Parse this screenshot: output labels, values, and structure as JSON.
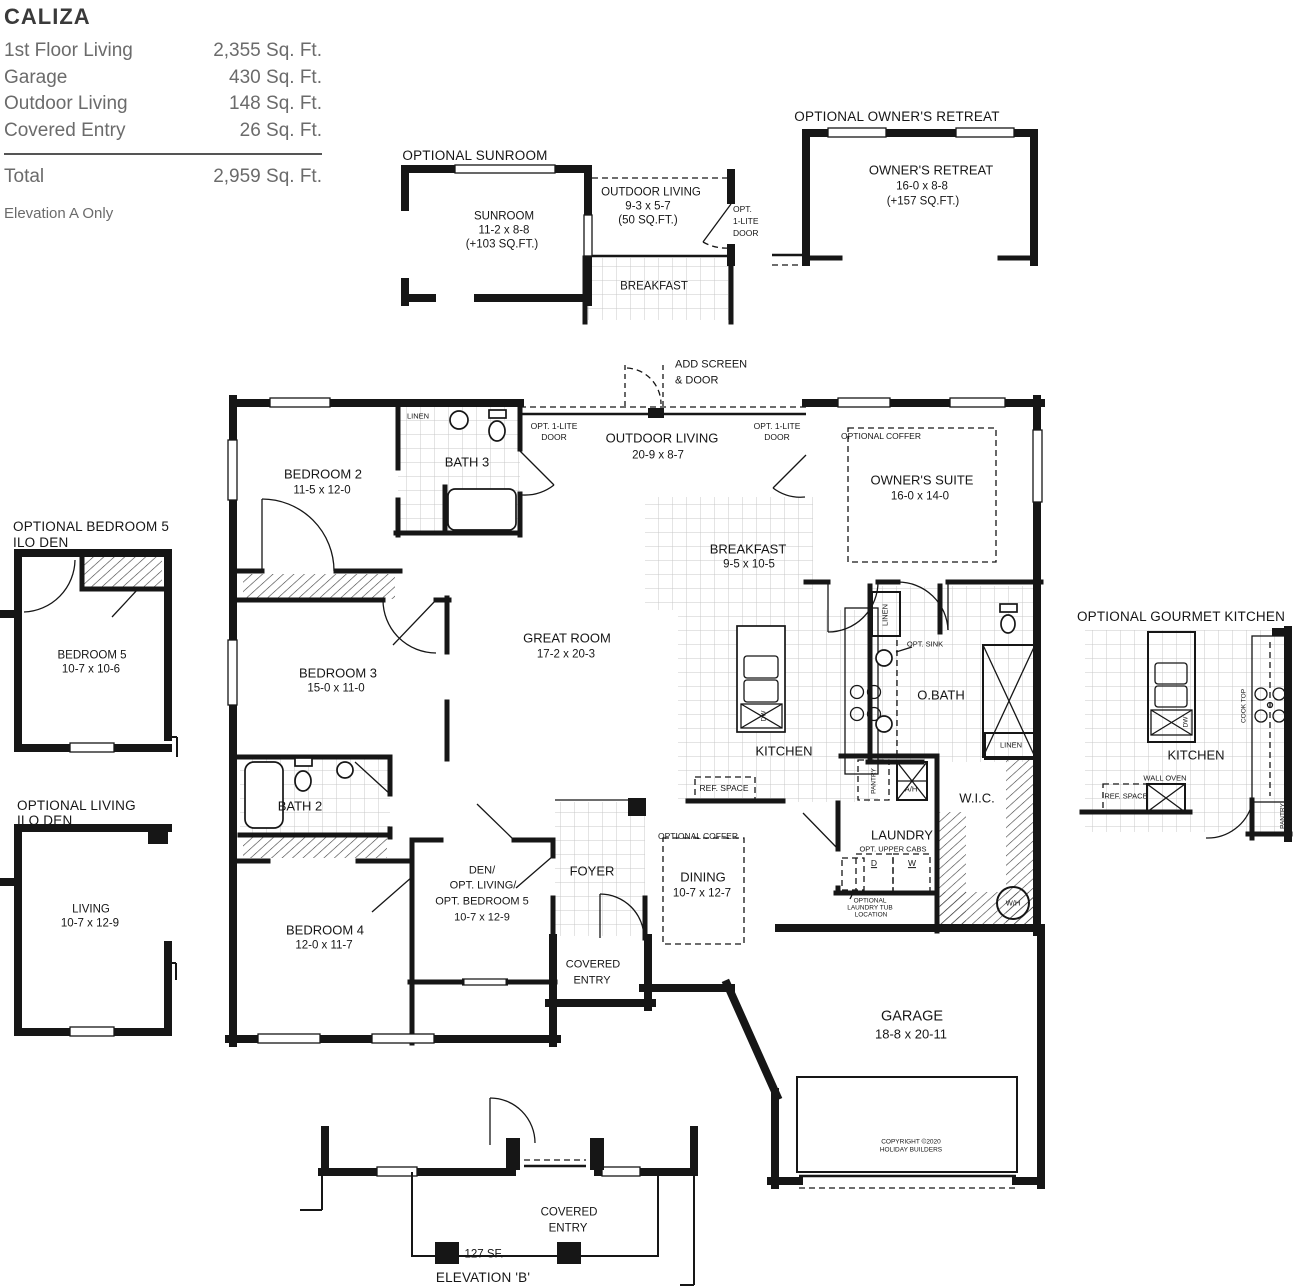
{
  "spec": {
    "title": "CALIZA",
    "rows": [
      {
        "label": "1st Floor Living",
        "value": "2,355 Sq. Ft."
      },
      {
        "label": "Garage",
        "value": "430 Sq. Ft."
      },
      {
        "label": "Outdoor Living",
        "value": "148 Sq. Ft."
      },
      {
        "label": "Covered Entry",
        "value": "26 Sq. Ft."
      }
    ],
    "total": {
      "label": "Total",
      "value": "2,959 Sq. Ft."
    },
    "note": "Elevation A Only"
  },
  "main": {
    "add_screen": [
      "ADD SCREEN",
      "& DOOR"
    ],
    "opt_door": [
      "OPT. 1-LITE",
      "DOOR"
    ],
    "outdoor_living": {
      "name": "OUTDOOR LIVING",
      "dims": "20-9 x 8-7"
    },
    "bedroom2": {
      "name": "BEDROOM 2",
      "dims": "11-5 x 12-0"
    },
    "bath3": {
      "name": "BATH 3",
      "linen": "LINEN"
    },
    "owners_suite": {
      "coffer": "OPTIONAL COFFER",
      "name": "OWNER'S SUITE",
      "dims": "16-0 x 14-0"
    },
    "breakfast": {
      "name": "BREAKFAST",
      "dims": "9-5 x 10-5"
    },
    "great_room": {
      "name": "GREAT ROOM",
      "dims": "17-2 x 20-3"
    },
    "bedroom3": {
      "name": "BEDROOM 3",
      "dims": "15-0 x 11-0"
    },
    "bath2": {
      "name": "BATH 2"
    },
    "obath": {
      "name": "O.BATH",
      "opt_sink": "OPT. SINK",
      "linen_v": "LINEN",
      "linen_h": "LINEN"
    },
    "kitchen": {
      "name": "KITCHEN",
      "ref_space": "REF. SPACE",
      "pantry": "PANTRY",
      "dw": "DW"
    },
    "laundry": {
      "name": "LAUNDRY",
      "upper_cabs": "OPT. UPPER CABS",
      "d": "D",
      "w": "W",
      "ah": "A/H",
      "tub": [
        "OPTIONAL",
        "LAUNDRY TUB",
        "LOCATION"
      ]
    },
    "wic": {
      "name": "W.I.C.",
      "wh": "W/H"
    },
    "dining": {
      "coffer": "OPTIONAL COFFER",
      "name": "DINING",
      "dims": "10-7 x 12-7"
    },
    "den": [
      "DEN/",
      "OPT. LIVING/",
      "OPT. BEDROOM 5",
      "10-7 x 12-9"
    ],
    "foyer": {
      "name": "FOYER"
    },
    "covered_entry": [
      "COVERED",
      "ENTRY"
    ],
    "bedroom4": {
      "name": "BEDROOM 4",
      "dims": "12-0 x 11-7"
    },
    "garage": {
      "name": "GARAGE",
      "dims": "18-8 x 20-11",
      "copyright": [
        "COPYRIGHT ©2020",
        "HOLIDAY BUILDERS"
      ]
    }
  },
  "sunroom_inset": {
    "title": "OPTIONAL SUNROOM",
    "name": "SUNROOM",
    "dims": "11-2 x 8-8",
    "area": "(+103 SQ.FT.)",
    "outdoor_living": {
      "name": "OUTDOOR LIVING",
      "dims": "9-3 x 5-7",
      "area": "(50 SQ.FT.)"
    },
    "door": [
      "OPT.",
      "1-LITE",
      "DOOR"
    ],
    "breakfast": "BREAKFAST"
  },
  "retreat_inset": {
    "title": "OPTIONAL OWNER'S RETREAT",
    "name": "OWNER'S RETREAT",
    "dims": "16-0 x 8-8",
    "area": "(+157 SQ.FT.)"
  },
  "bedroom5_inset": {
    "title": [
      "OPTIONAL BEDROOM 5",
      "ILO DEN"
    ],
    "name": "BEDROOM 5",
    "dims": "10-7 x 10-6"
  },
  "living_inset": {
    "title": [
      "OPTIONAL LIVING",
      "ILO DEN"
    ],
    "name": "LIVING",
    "dims": "10-7 x 12-9"
  },
  "gourmet_inset": {
    "title": "OPTIONAL GOURMET KITCHEN",
    "kitchen": "KITCHEN",
    "cook_top": "COOK TOP",
    "wall_oven": "WALL OVEN",
    "ref_space": "REF. SPACE",
    "pantry": "PANTRY",
    "dw": "DW"
  },
  "elevation_inset": {
    "covered": [
      "COVERED",
      "ENTRY"
    ],
    "sf": "127 SF.",
    "name": "ELEVATION 'B'"
  }
}
